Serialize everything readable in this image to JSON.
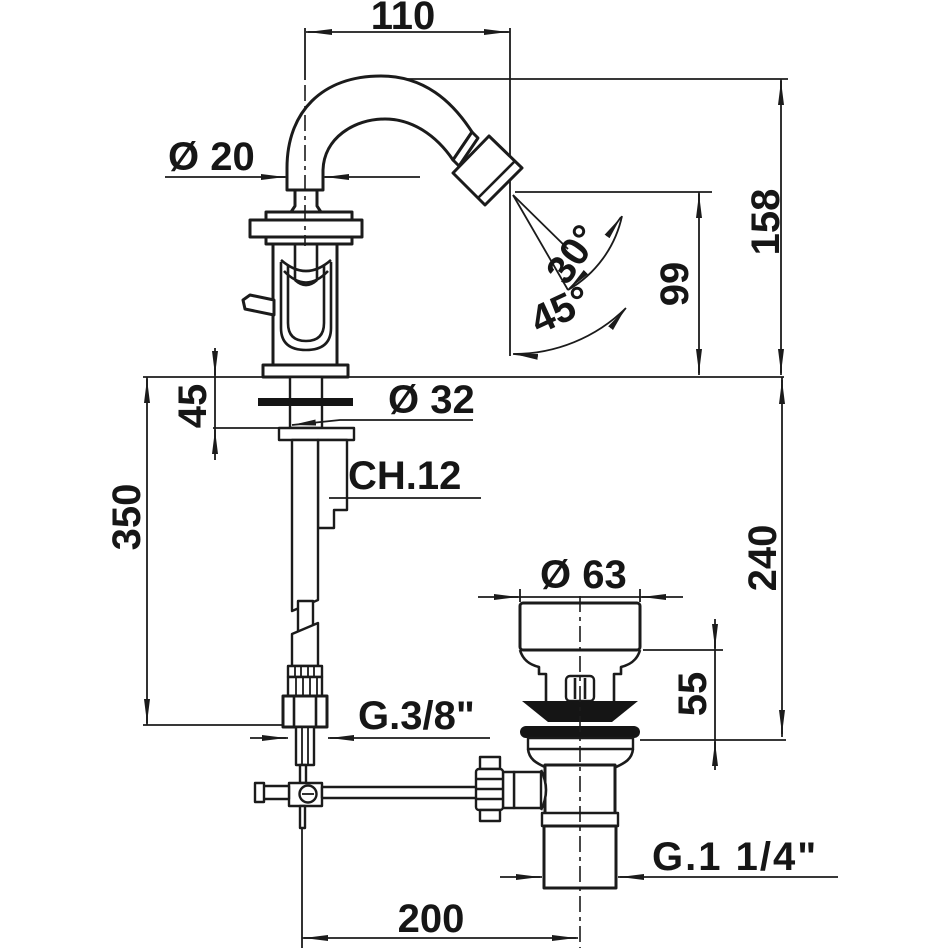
{
  "canvas": {
    "width": 950,
    "height": 950,
    "background": "#ffffff"
  },
  "colors": {
    "line": "#1b1b1b",
    "solid_fill": "#151515",
    "paper": "#ffffff"
  },
  "labels": {
    "spout_reach": "110",
    "spout_diameter": "Ø 20",
    "height_to_spout_top": "158",
    "outlet_height": "99",
    "spray_angle_min": "30°",
    "spray_angle_max": "45°",
    "deck_clamp_length": "45",
    "mounting_hole_diameter": "Ø 32",
    "wrench_size": "CH.12",
    "hose_length": "350",
    "depth_below_deck": "240",
    "waste_cap_diameter": "Ø 63",
    "waste_height": "55",
    "supply_connection": "G.3/8\"",
    "waste_connection": "G.1 1/4\"",
    "centre_distance": "200"
  }
}
